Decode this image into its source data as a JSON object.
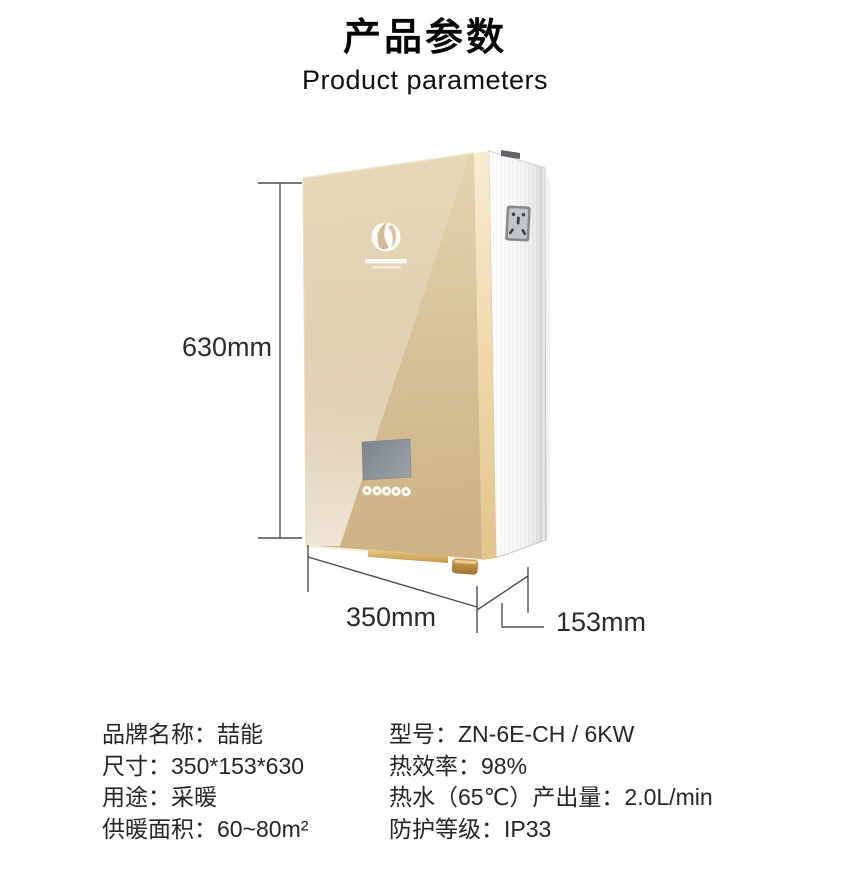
{
  "header": {
    "title": "产品参数",
    "subtitle": "Product parameters"
  },
  "figure": {
    "dimensions": {
      "height_label": "630mm",
      "width_label": "350mm",
      "depth_label": "153mm"
    },
    "product": {
      "front_panel_color": "#d6bf96",
      "edge_trim_color": "#eed9ab",
      "side_panel_color": "#f2f2f2",
      "gold_accent_color": "#c79b4e",
      "lcd_color": "#8b9198",
      "dimension_line_color": "#4d4d4d"
    }
  },
  "specs": {
    "left_column": [
      "品牌名称：喆能",
      "尺寸：350*153*630",
      "用途：采暖",
      "供暖面积：60~80m²"
    ],
    "right_column": [
      "型号：ZN-6E-CH / 6KW",
      "热效率：98%",
      "热水（65℃）产出量：2.0L/min",
      "防护等级：IP33"
    ]
  }
}
